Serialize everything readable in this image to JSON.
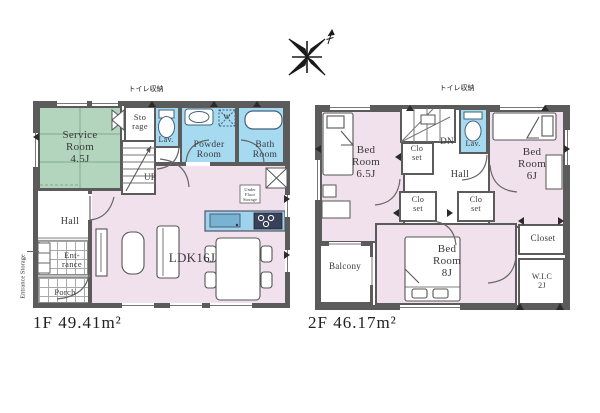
{
  "colors": {
    "wall": "#5b5b5b",
    "room_pink": "#f0e1ec",
    "room_green": "#b4d5bd",
    "room_blue": "#a6daf0",
    "counter_blue": "#9fd3ec",
    "appliance_dark": "#39415a"
  },
  "floor1": {
    "area_label": "1F 49.41m²",
    "toilet_storage_note": "トイレ収納",
    "entrance_storage_note": "Entrance Storage",
    "rooms": {
      "service_room": "Service\nRoom\n4.5J",
      "storage": "Sto\nrage",
      "lavatory": "Lav.",
      "powder_room": "Powder\nRoom",
      "bath_room": "Bath\nRoom",
      "stairs_up": "UP",
      "hall": "Hall",
      "entrance": "Ent-\nrance",
      "porch": "Porch",
      "ldk": "LDK16J",
      "under_floor_storage": "Under\nFloor\nStorage",
      "washing_machine": "W"
    }
  },
  "floor2": {
    "area_label": "2F 46.17m²",
    "toilet_storage_note": "トイレ収納",
    "rooms": {
      "bedroom_65": "Bed\nRoom\n6.5J",
      "stairs_down": "DN",
      "lavatory": "Lav.",
      "closet_a": "Clo\nset",
      "closet_b": "Clo\nset",
      "closet_c": "Clo\nset",
      "hall": "Hall",
      "bedroom_6": "Bed\nRoom\n6J",
      "balcony": "Balcony",
      "bedroom_8": "Bed\nRoom\n8J",
      "closet": "Closet",
      "wic": "W.I.C\n2J"
    }
  }
}
